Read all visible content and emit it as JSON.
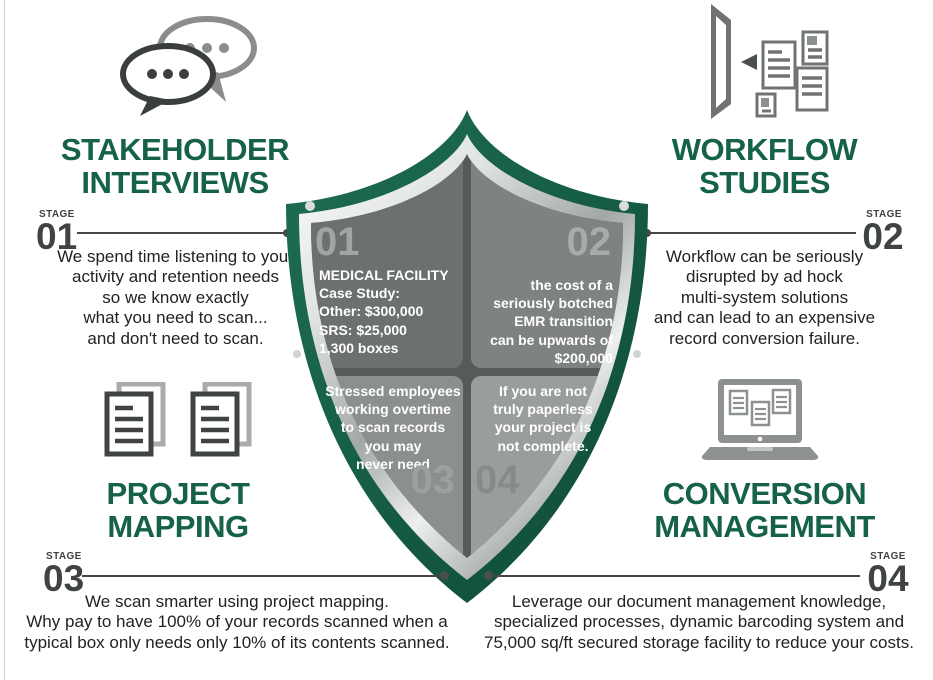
{
  "colors": {
    "accent_green": "#15614a",
    "stage_gray": "#3f4442",
    "body_text": "#222222",
    "shield_green_dark": "#0e4a38",
    "shield_green_light": "#1e6f54",
    "panel_grays": [
      "#6c716f",
      "#7e8280",
      "#8c908d",
      "#9a9e9b"
    ]
  },
  "icons": {
    "stakeholder": "chat-bubbles-icon",
    "workflow": "monitor-documents-icon",
    "project": "document-stacks-icon",
    "conversion": "laptop-documents-icon"
  },
  "sections": {
    "stakeholder": {
      "title": "STAKEHOLDER\nINTERVIEWS",
      "stage_label": "STAGE",
      "stage_number": "01",
      "body": "We spend time listening to your\nactivity and retention needs\nso we know exactly\nwhat you need to scan...\nand don't need to scan."
    },
    "workflow": {
      "title": "WORKFLOW\nSTUDIES",
      "stage_label": "STAGE",
      "stage_number": "02",
      "body": "Workflow can be seriously\ndisrupted by ad hock\nmulti-system solutions\nand can lead to an expensive\nrecord conversion failure."
    },
    "project": {
      "title": "PROJECT\nMAPPING",
      "stage_label": "STAGE",
      "stage_number": "03",
      "body": "We scan smarter using project mapping.\nWhy pay to have 100% of your records scanned when a\ntypical box only needs only 10% of its contents scanned."
    },
    "conversion": {
      "title": "CONVERSION\nMANAGEMENT",
      "stage_label": "STAGE",
      "stage_number": "04",
      "body": "Leverage our document management knowledge,\nspecialized processes, dynamic barcoding system and\n75,000 sq/ft secured storage facility to reduce your costs."
    }
  },
  "shield": {
    "quadrants": [
      {
        "number": "01",
        "text": "MEDICAL FACILITY\nCase Study:\nOther: $300,000\nSRS: $25,000\n1,300 boxes"
      },
      {
        "number": "02",
        "text": "the cost of a\nseriously botched\nEMR transition\ncan be upwards of\n$200,000"
      },
      {
        "number": "03",
        "text": "Stressed employees\nworking overtime\nto scan records\nyou may\nnever need"
      },
      {
        "number": "04",
        "text": "If you are not\ntruly paperless\nyour project is\nnot complete."
      }
    ]
  }
}
